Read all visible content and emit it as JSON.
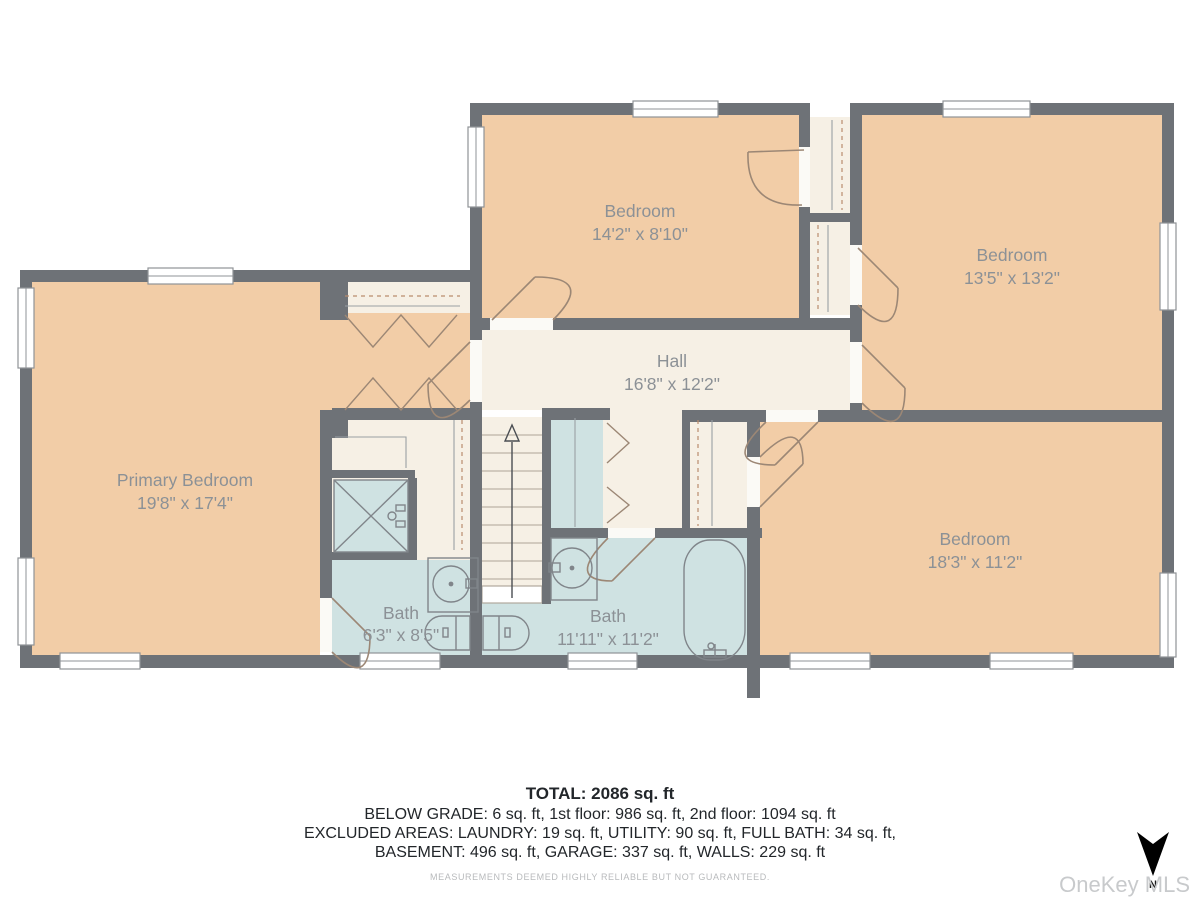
{
  "title": "Second floor plan",
  "rooms": [
    {
      "name": "Bedroom",
      "dims": "14'2\" x 8'10\""
    },
    {
      "name": "Bedroom",
      "dims": "13'5\" x 13'2\""
    },
    {
      "name": "Hall",
      "dims": "16'8\" x 12'2\""
    },
    {
      "name": "Primary Bedroom",
      "dims": "19'8\" x 17'4\""
    },
    {
      "name": "Bath",
      "dims": "6'3\" x 8'5\""
    },
    {
      "name": "Bath",
      "dims": "11'11\" x 11'2\""
    },
    {
      "name": "Bedroom",
      "dims": "18'3\" x 11'2\""
    }
  ],
  "footer": {
    "total": "TOTAL: 2086 sq. ft",
    "line1": "BELOW GRADE: 6 sq. ft, 1st floor: 986 sq. ft, 2nd floor: 1094 sq. ft",
    "line2": "EXCLUDED AREAS: LAUNDRY: 19 sq. ft, UTILITY: 90 sq. ft, FULL BATH: 34 sq. ft,",
    "line3": "BASEMENT: 496 sq. ft, GARAGE: 337 sq. ft, WALLS: 229 sq. ft",
    "disclaimer": "MEASUREMENTS DEEMED HIGHLY RELIABLE BUT NOT GUARANTEED."
  },
  "watermark": "OneKey MLS",
  "compass": {
    "label": "N"
  },
  "colors": {
    "wall": "#6e7277",
    "bedroom_fill": "#f2cda7",
    "hall_fill": "#f6f0e5",
    "wet_area_fill": "#cfe2e2",
    "door_swing": "#9c8775",
    "room_label": "#8c9196",
    "footer_text": "#22262a",
    "watermark": "#c8cacc",
    "north_arrow": "#000000"
  }
}
